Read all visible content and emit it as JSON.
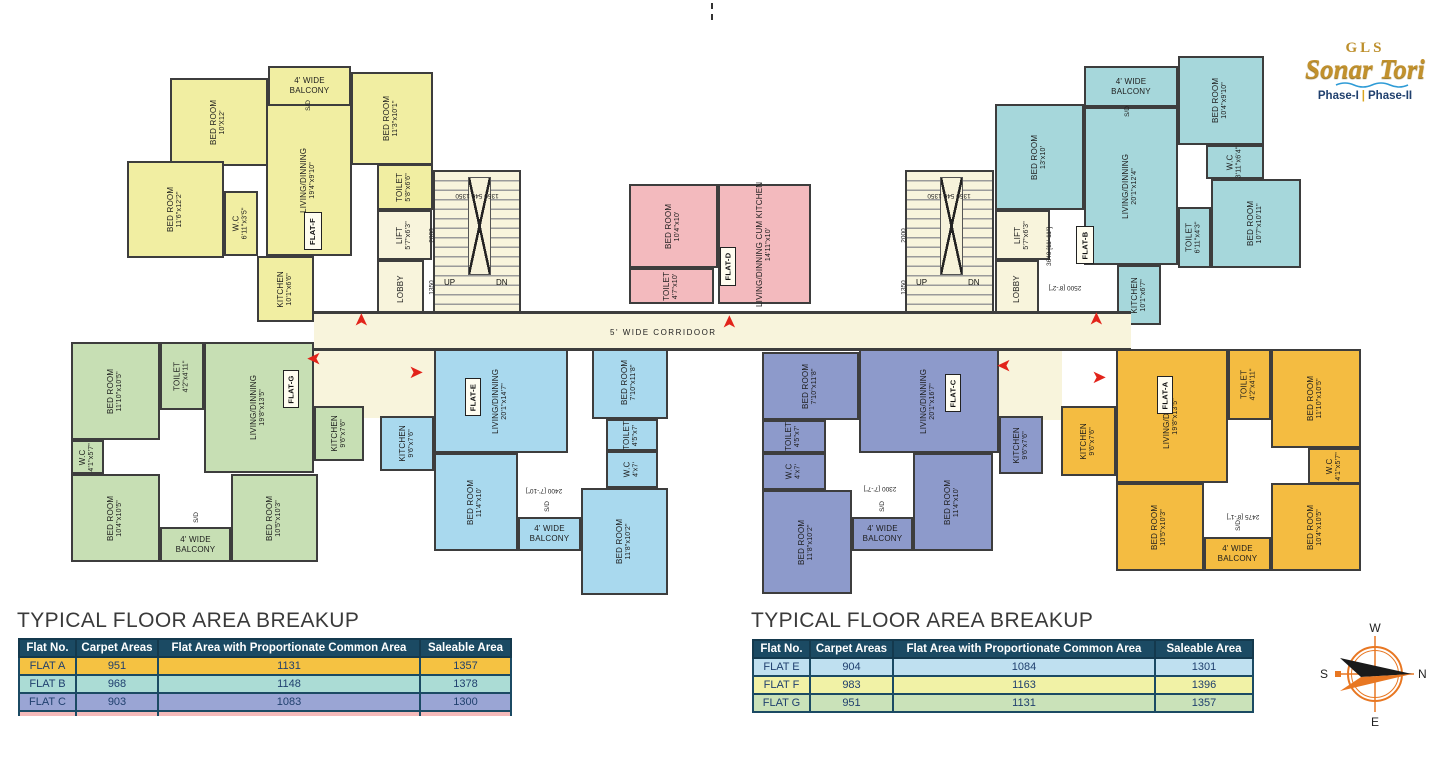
{
  "logo": {
    "brand": "GLS",
    "name": "Sonar Tori",
    "phase1": "Phase-I",
    "phase2": "Phase-II",
    "sep": "|",
    "accent_gold": "#C2912C",
    "accent_navy": "#20406E",
    "wave_blue": "#2E9BD6"
  },
  "compass": {
    "w": "W",
    "n": "N",
    "s": "S",
    "e": "E",
    "ring_color": "#E87722"
  },
  "colors": {
    "wall": "#3d3d3d",
    "corridor_cream": "#F8F4DC",
    "arrow_red": "#E2231A",
    "table_header": "#1B4A63"
  },
  "plan": {
    "corridor_label": "5' WIDE CORRIDOOR",
    "sd": "S/D",
    "stairs": {
      "up": "UP",
      "dn": "DN",
      "dims_top": "1350   540   1350",
      "dim_2000": "2000",
      "dim_1350": "1350"
    },
    "core": {
      "lift": "LIFT",
      "lift_dims": "5'7\"x6'3\"",
      "lobby": "LOBBY"
    },
    "dims": {
      "b_v": "3640 [11'-11\"]",
      "b_h": "2500 [8'-2\"]",
      "e": "2400 [7'-10\"]",
      "c": "2300 [7'-7\"]",
      "a": "2475 [8'-1\"]"
    },
    "flats": {
      "f": {
        "id": "FLAT-F",
        "color": "#F1EEA2",
        "rooms": [
          {
            "name": "BED ROOM",
            "dims": "10'X12'"
          },
          {
            "name": "4' WIDE BALCONY",
            "dims": ""
          },
          {
            "name": "BED ROOM",
            "dims": "11'3\"x10'1\""
          },
          {
            "name": "BED ROOM",
            "dims": "11'6\"x12'2\""
          },
          {
            "name": "W.C",
            "dims": "6'11\"x3'5\""
          },
          {
            "name": "LIVING/DINNING",
            "dims": "19'4\"x9'10\""
          },
          {
            "name": "KITCHEN",
            "dims": "10'1\"x6'6\""
          },
          {
            "name": "TOILET",
            "dims": "5'8\"x6'6\""
          }
        ]
      },
      "b": {
        "id": "FLAT-B",
        "color": "#A6D7DB",
        "rooms": [
          {
            "name": "BED ROOM",
            "dims": "13'x10'"
          },
          {
            "name": "4' WIDE BALCONY",
            "dims": ""
          },
          {
            "name": "BED ROOM",
            "dims": "10'4\"x9'10\""
          },
          {
            "name": "W.C",
            "dims": "3'11\"x6'4\""
          },
          {
            "name": "LIVING/DINNING",
            "dims": "20'1\"x12'4\""
          },
          {
            "name": "TOILET",
            "dims": "6'11\"x4'3\""
          },
          {
            "name": "BED ROOM",
            "dims": "10'7\"x10'11\""
          },
          {
            "name": "KITCHEN",
            "dims": "10'1\"x6'7\""
          }
        ]
      },
      "d": {
        "id": "FLAT-D",
        "color": "#F3BABE",
        "rooms": [
          {
            "name": "BED ROOM",
            "dims": "10'4\"x10'"
          },
          {
            "name": "TOILET",
            "dims": "4'7\"x10'"
          },
          {
            "name": "LIVING/DINNING CUM KITCHEN",
            "dims": "14'11\"x10'"
          }
        ]
      },
      "g": {
        "id": "FLAT-G",
        "color": "#C7DFB4",
        "rooms": [
          {
            "name": "BED ROOM",
            "dims": "11'10\"x10'5\""
          },
          {
            "name": "TOILET",
            "dims": "4'2\"x4'11\""
          },
          {
            "name": "LIVING/DINNING",
            "dims": "19'8\"x13'5\""
          },
          {
            "name": "KITCHEN",
            "dims": "9'6\"x7'6\""
          },
          {
            "name": "W.C",
            "dims": "4'1\"x5'7\""
          },
          {
            "name": "BED ROOM",
            "dims": "10'4\"x10'5\""
          },
          {
            "name": "4' WIDE BALCONY",
            "dims": ""
          },
          {
            "name": "BED ROOM",
            "dims": "10'5\"x10'3\""
          }
        ]
      },
      "e": {
        "id": "FLAT-E",
        "color": "#A9D9EE",
        "rooms": [
          {
            "name": "KITCHEN",
            "dims": "9'6\"x7'6\""
          },
          {
            "name": "LIVING/DINNING",
            "dims": "20'1\"x14'7\""
          },
          {
            "name": "BED ROOM",
            "dims": "7'10\"x11'8\""
          },
          {
            "name": "TOILET",
            "dims": "4'5\"x7'"
          },
          {
            "name": "W.C",
            "dims": "4'x7'"
          },
          {
            "name": "BED ROOM",
            "dims": "11'4\"x10'"
          },
          {
            "name": "4' WIDE BALCONY",
            "dims": ""
          },
          {
            "name": "BED ROOM",
            "dims": "11'8\"x10'2\""
          }
        ]
      },
      "c": {
        "id": "FLAT-C",
        "color": "#8D9ACB",
        "rooms": [
          {
            "name": "BED ROOM",
            "dims": "7'10\"x11'8\""
          },
          {
            "name": "TOILET",
            "dims": "4'5\"x7'"
          },
          {
            "name": "W.C",
            "dims": "4'x7'"
          },
          {
            "name": "LIVING/DINNING",
            "dims": "20'1\"x16'7\""
          },
          {
            "name": "KITCHEN",
            "dims": "9'6\"x7'6\""
          },
          {
            "name": "BED ROOM",
            "dims": "11'4\"x10'"
          },
          {
            "name": "4' WIDE BALCONY",
            "dims": ""
          },
          {
            "name": "BED ROOM",
            "dims": "11'8\"x10'2\""
          }
        ]
      },
      "a": {
        "id": "FLAT-A",
        "color": "#F4BC41",
        "rooms": [
          {
            "name": "KITCHEN",
            "dims": "9'6\"x7'6\""
          },
          {
            "name": "LIVING/DINNING",
            "dims": "19'8\"x13'5\""
          },
          {
            "name": "TOILET",
            "dims": "4'2\"x4'11\""
          },
          {
            "name": "BED ROOM",
            "dims": "11'10\"x10'5\""
          },
          {
            "name": "W.C",
            "dims": "4'1\"x5'7\""
          },
          {
            "name": "BED ROOM",
            "dims": "10'5\"x10'3\""
          },
          {
            "name": "4' WIDE BALCONY",
            "dims": ""
          },
          {
            "name": "BED ROOM",
            "dims": "10'4\"x10'5\""
          }
        ]
      }
    }
  },
  "tables": {
    "title": "TYPICAL FLOOR AREA BREAKUP",
    "headers": [
      "Flat No.",
      "Carpet Areas",
      "Flat Area with Proportionate Common Area",
      "Saleable Area"
    ],
    "left": {
      "rows": [
        [
          "FLAT A",
          "951",
          "1131",
          "1357"
        ],
        [
          "FLAT B",
          "968",
          "1148",
          "1378"
        ],
        [
          "FLAT C",
          "903",
          "1083",
          "1300"
        ]
      ]
    },
    "right": {
      "rows": [
        [
          "FLAT E",
          "904",
          "1084",
          "1301"
        ],
        [
          "FLAT F",
          "983",
          "1163",
          "1396"
        ],
        [
          "FLAT G",
          "951",
          "1131",
          "1357"
        ]
      ]
    }
  }
}
